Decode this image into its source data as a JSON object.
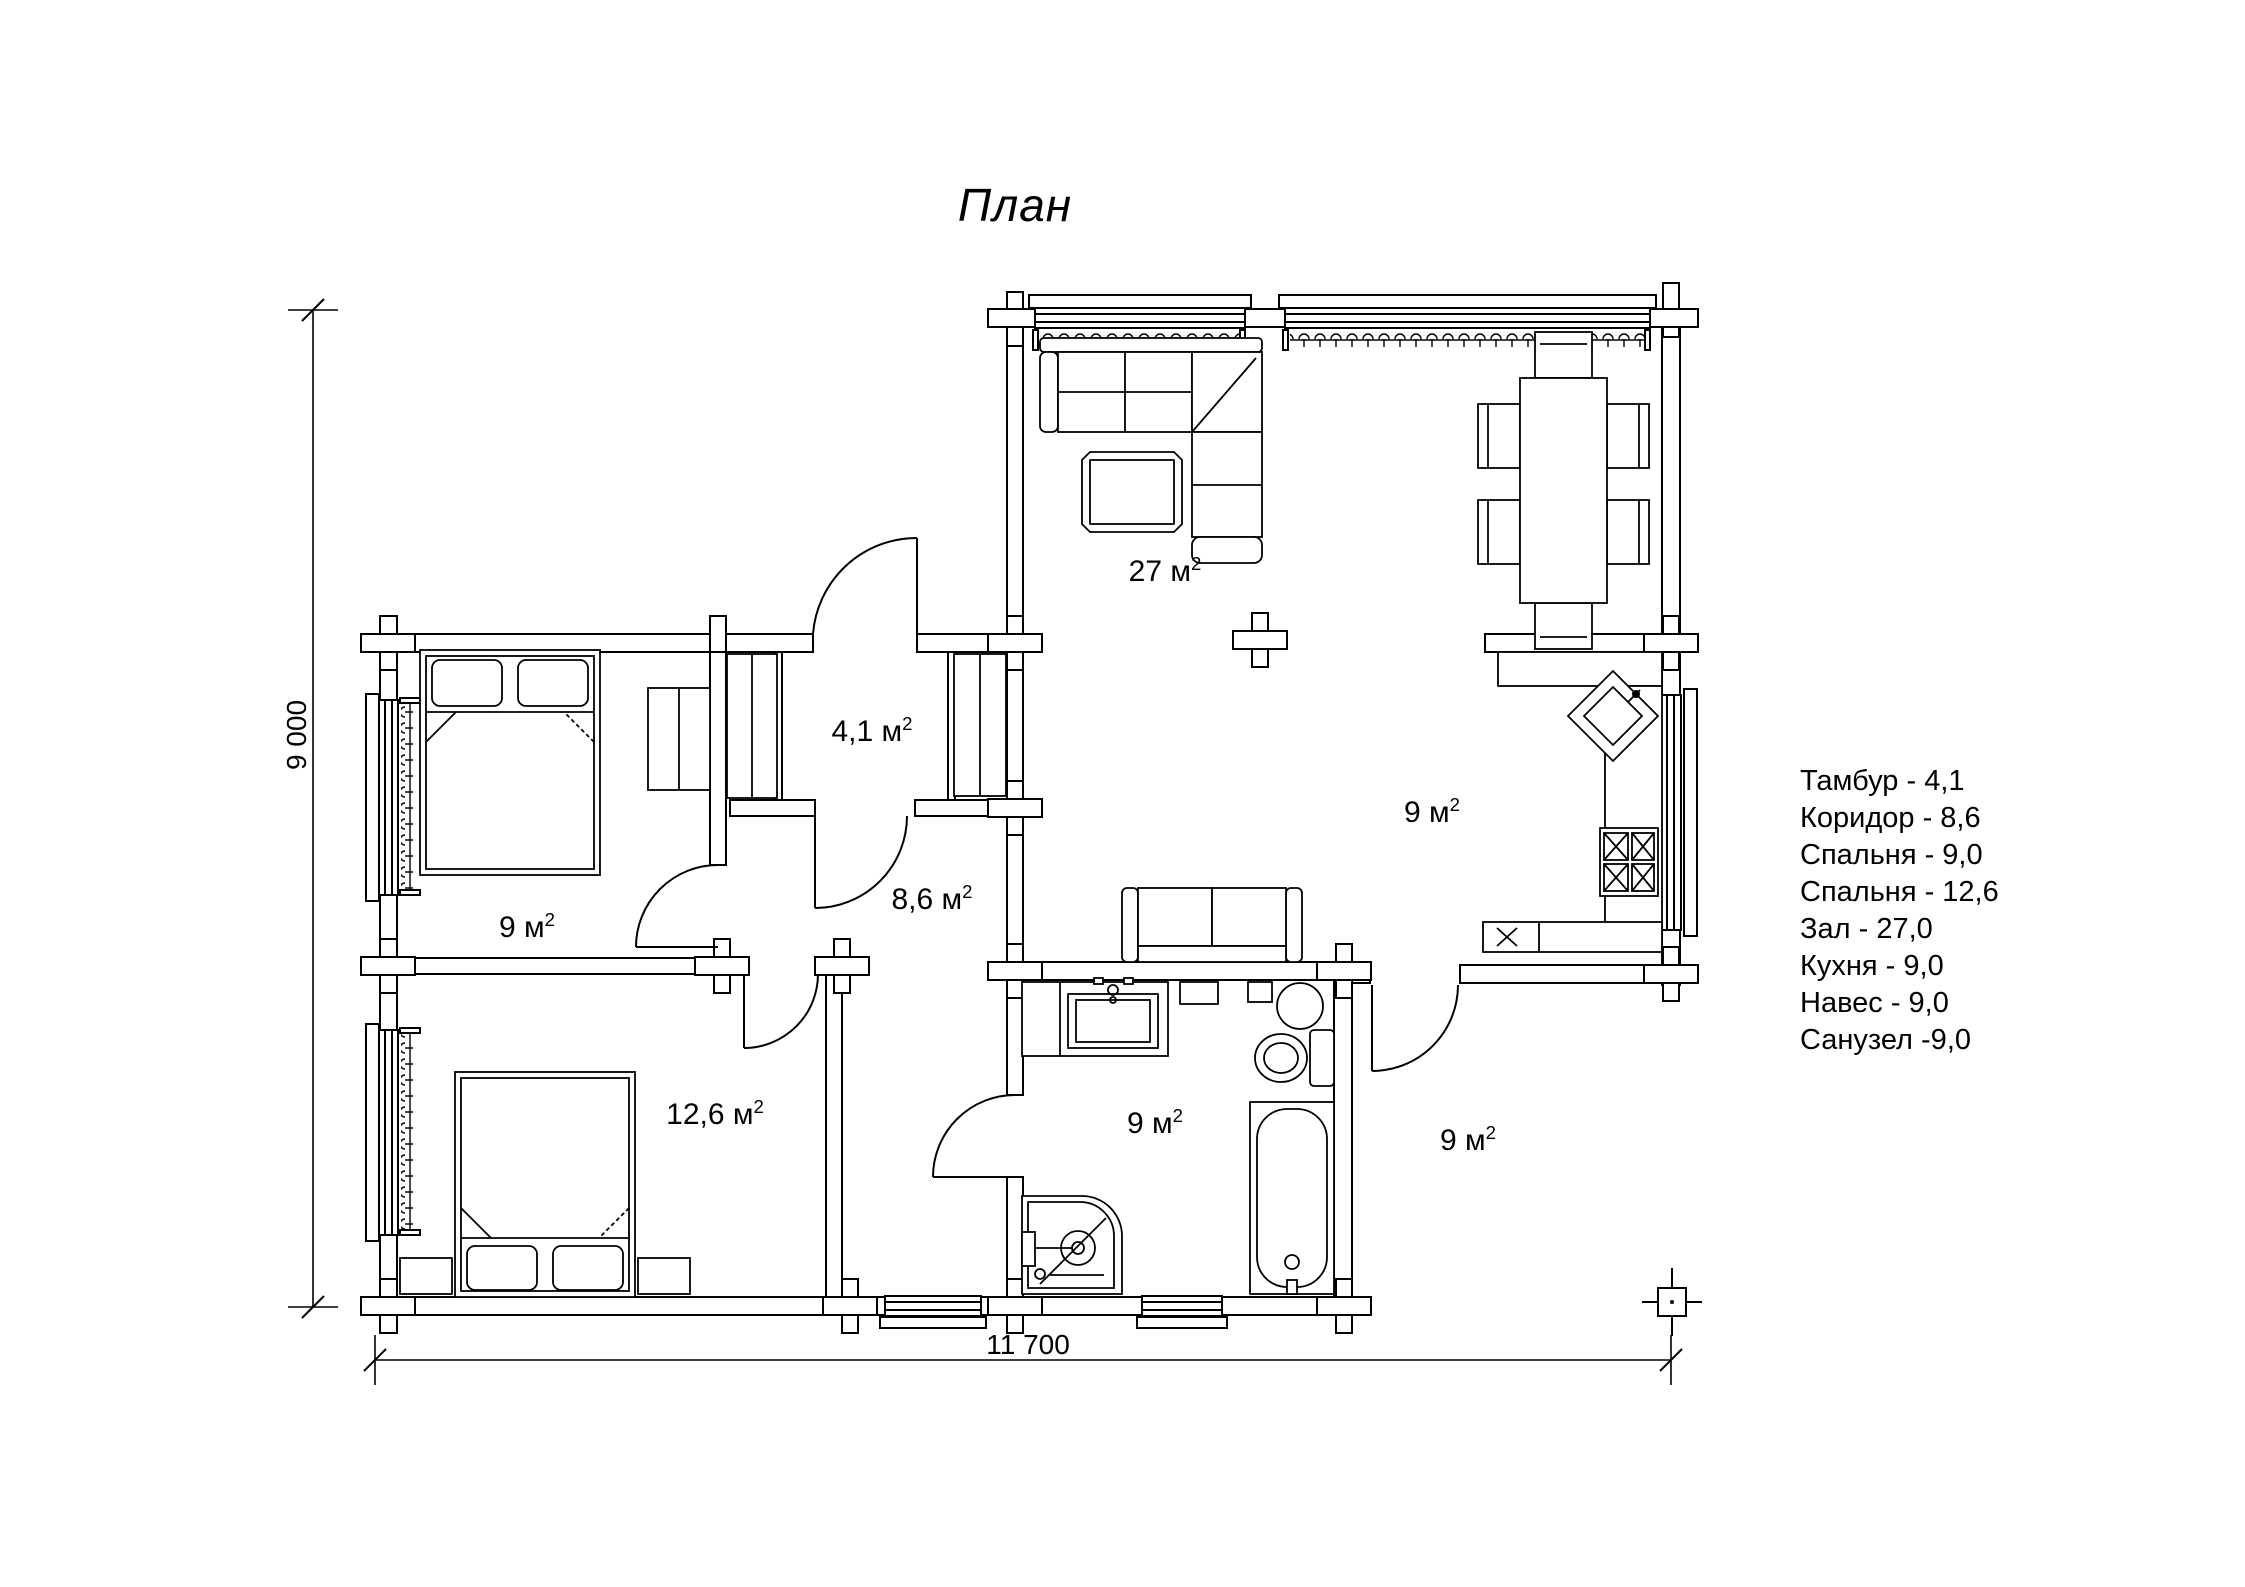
{
  "title": "План",
  "sup": "2",
  "rooms": {
    "hall": {
      "name": "Зал",
      "label": "27 м"
    },
    "vestibule": {
      "name": "Тамбур",
      "label": "4,1 м"
    },
    "corridor": {
      "name": "Коридор",
      "label": "8,6 м"
    },
    "bedroom1": {
      "name": "Спальня",
      "label": "9 м"
    },
    "bedroom2": {
      "name": "Спальня",
      "label": "12,6 м"
    },
    "bathroom": {
      "name": "Санузел",
      "label": "9 м"
    },
    "kitchen": {
      "name": "Кухня",
      "label": "9 м"
    },
    "canopy": {
      "name": "Навес",
      "label": "9 м"
    }
  },
  "legend": {
    "items": [
      "Тамбур - 4,1",
      "Коридор - 8,6",
      "Спальня - 9,0",
      "Спальня - 12,6",
      "Зал - 27,0",
      "Кухня - 9,0",
      "Навес - 9,0",
      "Санузел  -9,0"
    ]
  },
  "dimensions": {
    "width_label": "11 700",
    "height_label": "9 000"
  }
}
